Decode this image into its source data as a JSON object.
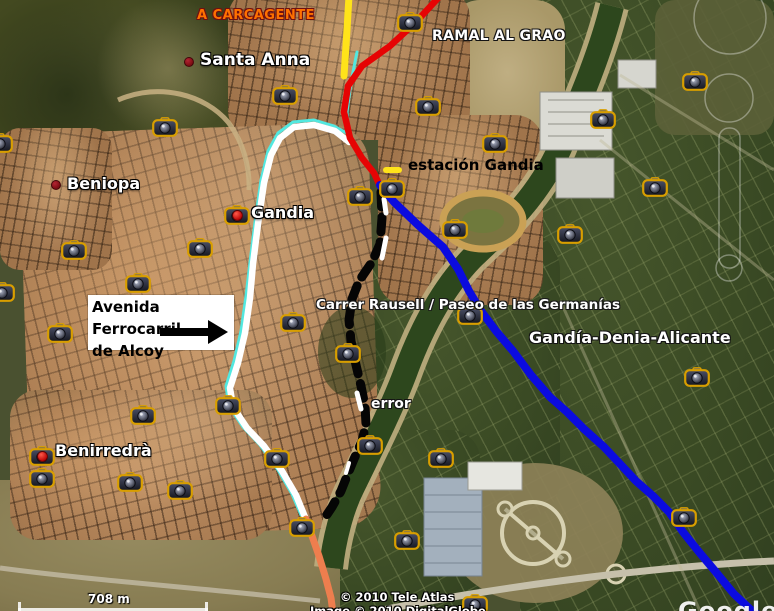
{
  "canvas": {
    "width": 774,
    "height": 611
  },
  "attribution": {
    "line1": "© 2010 Tele Atlas",
    "line2": "Image © 2010 DigitalGlobe",
    "watermark": "Google"
  },
  "scale_bar": {
    "label": "708 m"
  },
  "info_box": {
    "line1": "Avenida Ferrocarril",
    "line2": "de Alcoy"
  },
  "colors": {
    "red": "#e60404",
    "blue": "#0b0bdf",
    "yellow": "#ffe31a",
    "cyan": "#52e8e0",
    "white": "#ffffff",
    "orange": "#ee7e4e",
    "black": "#050505"
  },
  "place_labels": [
    {
      "id": "santa-anna",
      "text": "Santa Anna",
      "x": 200,
      "y": 50,
      "size": 17,
      "dot": {
        "x": 184,
        "y": 57
      }
    },
    {
      "id": "beniopa",
      "text": "Beniopa",
      "x": 67,
      "y": 174,
      "size": 16,
      "dot": {
        "x": 51,
        "y": 180
      }
    },
    {
      "id": "gandia",
      "text": "Gandia",
      "x": 251,
      "y": 203,
      "size": 16
    },
    {
      "id": "benirredra",
      "text": "Benirredrà",
      "x": 55,
      "y": 441,
      "size": 16
    }
  ],
  "route_labels": [
    {
      "id": "a-carcagente",
      "text": "A CARCAGENTE",
      "x": 197,
      "y": 8,
      "size": 13,
      "color": "#ff7100",
      "outline": "#701010",
      "spacing": 0.5
    },
    {
      "id": "ramal-al-grao",
      "text": "RAMAL AL GRAO",
      "x": 432,
      "y": 28,
      "size": 14,
      "color": "#ffffff",
      "outline": "#141414",
      "spacing": 0.3
    },
    {
      "id": "estacion-gandia",
      "text": "estación Gandia",
      "x": 408,
      "y": 156,
      "size": 15,
      "color": "#000000",
      "outline": "",
      "spacing": 0
    },
    {
      "id": "carrer-rausell",
      "text": "Carrer Rausell / Paseo de las Germanías",
      "x": 316,
      "y": 297,
      "size": 13.5,
      "color": "#ffffff",
      "outline": "#1a1a1a",
      "spacing": 0
    },
    {
      "id": "gandia-denia-alicante",
      "text": "Gandía-Denia-Alicante",
      "x": 529,
      "y": 328,
      "size": 16,
      "color": "#ffffff",
      "outline": "#141414",
      "spacing": 0
    },
    {
      "id": "error",
      "text": "error",
      "x": 371,
      "y": 396,
      "size": 14,
      "color": "#ffffff",
      "outline": "#141414",
      "spacing": 0
    }
  ],
  "routes": [
    {
      "name": "cyan-line",
      "color_key": "cyan",
      "width": 3,
      "points": [
        [
          357,
          52
        ],
        [
          351,
          82
        ],
        [
          347,
          112
        ],
        [
          348,
          134
        ],
        [
          334,
          126
        ],
        [
          314,
          120
        ],
        [
          293,
          122
        ],
        [
          278,
          133
        ],
        [
          268,
          151
        ],
        [
          261,
          180
        ],
        [
          255,
          222
        ],
        [
          250,
          262
        ],
        [
          246,
          296
        ],
        [
          241,
          331
        ],
        [
          234,
          361
        ],
        [
          226,
          386
        ],
        [
          229,
          406
        ],
        [
          243,
          427
        ],
        [
          260,
          445
        ],
        [
          278,
          470
        ],
        [
          292,
          494
        ],
        [
          301,
          515
        ]
      ]
    },
    {
      "name": "white-line-avenida",
      "color_key": "white",
      "width": 6.5,
      "points": [
        [
          349,
          142
        ],
        [
          335,
          131
        ],
        [
          314,
          125
        ],
        [
          294,
          127
        ],
        [
          280,
          138
        ],
        [
          271,
          155
        ],
        [
          264,
          183
        ],
        [
          258,
          224
        ],
        [
          253,
          264
        ],
        [
          250,
          298
        ],
        [
          245,
          333
        ],
        [
          238,
          363
        ],
        [
          230,
          388
        ],
        [
          233,
          407
        ],
        [
          247,
          428
        ],
        [
          264,
          446
        ],
        [
          282,
          471
        ],
        [
          296,
          495
        ],
        [
          305,
          517
        ]
      ]
    },
    {
      "name": "yellow-line-carcagente",
      "color_key": "yellow",
      "width": 7,
      "points": [
        [
          349,
          -4
        ],
        [
          347,
          30
        ],
        [
          344,
          76
        ]
      ]
    },
    {
      "name": "station-yellow-dash",
      "color_key": "yellow",
      "width": 6,
      "points": [
        [
          386,
          170
        ],
        [
          399,
          170
        ]
      ]
    },
    {
      "name": "red-line-ramal",
      "color_key": "red",
      "width": 6.5,
      "points": [
        [
          440,
          -4
        ],
        [
          416,
          22
        ],
        [
          390,
          46
        ],
        [
          362,
          66
        ],
        [
          348,
          86
        ],
        [
          344,
          112
        ],
        [
          350,
          138
        ],
        [
          362,
          158
        ],
        [
          374,
          173
        ],
        [
          380,
          186
        ]
      ]
    },
    {
      "name": "black-dashed-line",
      "color_key": "black",
      "width": 9,
      "dash": "15 10",
      "points": [
        [
          381,
          192
        ],
        [
          382,
          218
        ],
        [
          380,
          244
        ],
        [
          372,
          262
        ],
        [
          359,
          281
        ],
        [
          352,
          299
        ],
        [
          349,
          320
        ],
        [
          351,
          341
        ],
        [
          356,
          365
        ],
        [
          361,
          386
        ],
        [
          365,
          406
        ],
        [
          366,
          424
        ],
        [
          362,
          441
        ],
        [
          354,
          459
        ],
        [
          347,
          476
        ],
        [
          341,
          491
        ],
        [
          332,
          507
        ],
        [
          326,
          516
        ]
      ]
    },
    {
      "name": "white-dash-1",
      "color_key": "white",
      "width": 5,
      "points": [
        [
          384,
          199
        ],
        [
          386,
          213
        ]
      ]
    },
    {
      "name": "white-dash-2",
      "color_key": "white",
      "width": 5,
      "points": [
        [
          386,
          238
        ],
        [
          382,
          258
        ]
      ]
    },
    {
      "name": "white-dash-3",
      "color_key": "white",
      "width": 5,
      "points": [
        [
          357,
          393
        ],
        [
          361,
          409
        ]
      ]
    },
    {
      "name": "white-dash-4",
      "color_key": "white",
      "width": 4,
      "points": [
        [
          349,
          463
        ],
        [
          346,
          473
        ]
      ]
    },
    {
      "name": "orange-line",
      "color_key": "orange",
      "width": 7,
      "points": [
        [
          306,
          519
        ],
        [
          312,
          536
        ],
        [
          319,
          556
        ],
        [
          326,
          579
        ],
        [
          331,
          598
        ],
        [
          333,
          613
        ]
      ]
    },
    {
      "name": "blue-line-gandia-denia",
      "color_key": "blue",
      "width": 8,
      "points": [
        [
          380,
          185
        ],
        [
          394,
          202
        ],
        [
          418,
          225
        ],
        [
          443,
          247
        ],
        [
          458,
          269
        ],
        [
          469,
          291
        ],
        [
          481,
          311
        ],
        [
          496,
          331
        ],
        [
          513,
          351
        ],
        [
          531,
          375
        ],
        [
          550,
          397
        ],
        [
          567,
          412
        ],
        [
          584,
          429
        ],
        [
          604,
          447
        ],
        [
          621,
          465
        ],
        [
          636,
          481
        ],
        [
          653,
          496
        ],
        [
          669,
          512
        ],
        [
          683,
          532
        ],
        [
          699,
          552
        ],
        [
          715,
          571
        ],
        [
          734,
          594
        ],
        [
          750,
          609
        ],
        [
          757,
          614
        ]
      ]
    }
  ],
  "cameras": [
    {
      "x": 0,
      "y": 143
    },
    {
      "x": 165,
      "y": 127
    },
    {
      "x": 285,
      "y": 95
    },
    {
      "x": 410,
      "y": 22
    },
    {
      "x": 428,
      "y": 106
    },
    {
      "x": 495,
      "y": 143
    },
    {
      "x": 392,
      "y": 188
    },
    {
      "x": 360,
      "y": 196
    },
    {
      "x": 455,
      "y": 229
    },
    {
      "x": 570,
      "y": 234
    },
    {
      "x": 603,
      "y": 119
    },
    {
      "x": 655,
      "y": 187
    },
    {
      "x": 695,
      "y": 81
    },
    {
      "x": 237,
      "y": 215,
      "red_dot": true
    },
    {
      "x": 74,
      "y": 250
    },
    {
      "x": 200,
      "y": 248
    },
    {
      "x": 2,
      "y": 292
    },
    {
      "x": 60,
      "y": 333
    },
    {
      "x": 138,
      "y": 283
    },
    {
      "x": 293,
      "y": 322
    },
    {
      "x": 348,
      "y": 353
    },
    {
      "x": 470,
      "y": 315
    },
    {
      "x": 697,
      "y": 377
    },
    {
      "x": 370,
      "y": 445
    },
    {
      "x": 441,
      "y": 458
    },
    {
      "x": 143,
      "y": 415
    },
    {
      "x": 42,
      "y": 456,
      "red_dot": true
    },
    {
      "x": 42,
      "y": 478
    },
    {
      "x": 130,
      "y": 482
    },
    {
      "x": 180,
      "y": 490
    },
    {
      "x": 228,
      "y": 405
    },
    {
      "x": 277,
      "y": 458
    },
    {
      "x": 302,
      "y": 527
    },
    {
      "x": 407,
      "y": 540
    },
    {
      "x": 475,
      "y": 604
    },
    {
      "x": 684,
      "y": 517
    }
  ]
}
